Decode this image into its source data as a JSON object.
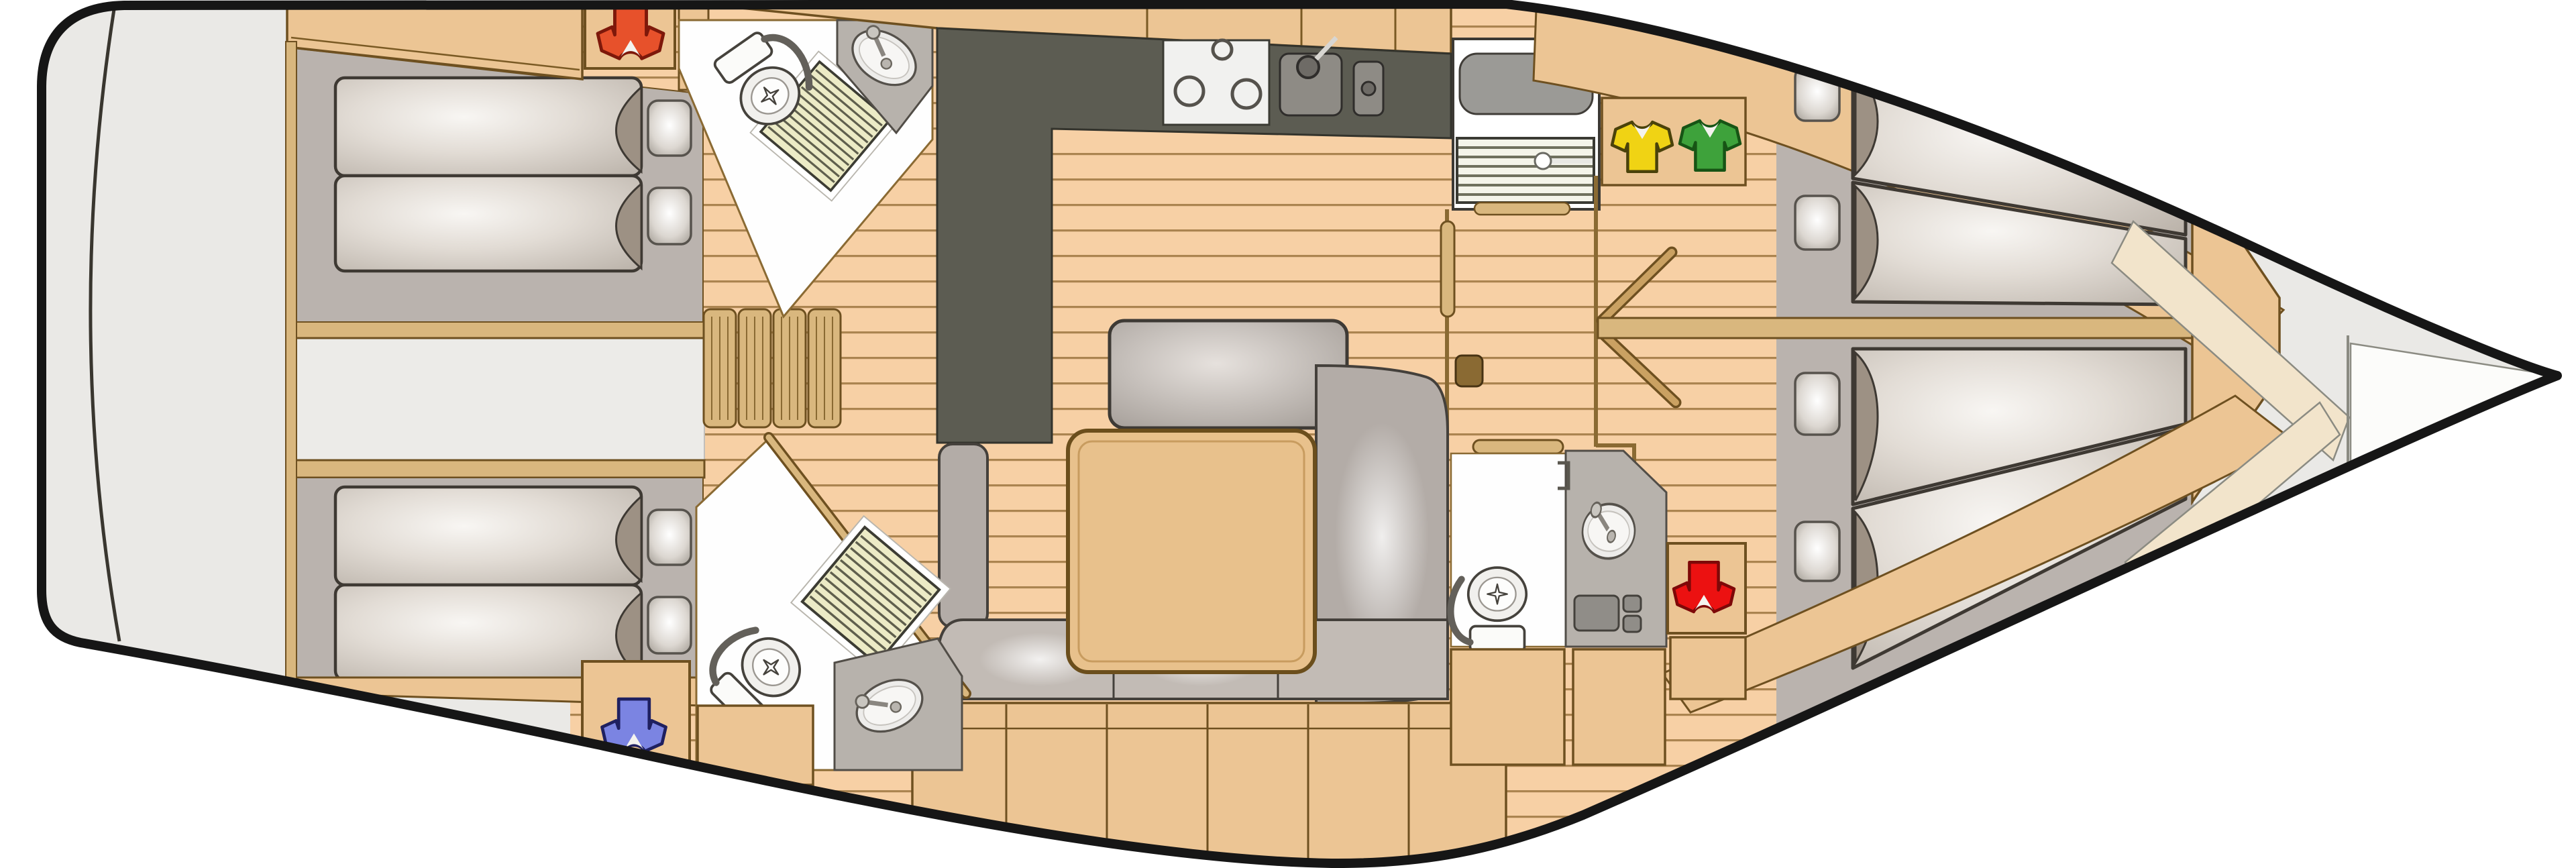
{
  "app": {
    "name": "yacht-floorplan",
    "description": "Top-view interior layout plan of a sailing yacht, bow pointing right"
  },
  "palette": {
    "hull_outline": "#161616",
    "deck": "#eae9e6",
    "floor": "#f7d0a5",
    "plank_line": "#ab8450",
    "wood": "#ecc594",
    "wood_light": "#d9b77e",
    "wood_dark": "#6e5020",
    "cabin_floor": "#bab3ae",
    "galley_counter": "#5c5c52",
    "counter_gray": "#b7b2ac",
    "white": "#fefefe",
    "shower_grate": "#ecebc6",
    "mattress_edge": "#3e3933",
    "sofa": "#b3aca7",
    "cushion": "#c2bbb5",
    "table": "#e8c18c",
    "bow_cream": "#f2e4cb"
  },
  "icons": {
    "orange_shirt": {
      "label": "crew berth marker - aft port cabin",
      "color": "#e7512b",
      "outline": "#7e180a"
    },
    "blue_shirt": {
      "label": "crew berth marker - aft starboard cabin",
      "color": "#7b84e2",
      "outline": "#1f2060"
    },
    "yellow_shirt": {
      "label": "crew berth marker - forward port cabin",
      "color": "#f0d314",
      "outline": "#4a420a"
    },
    "green_shirt": {
      "label": "crew berth marker - forward starboard cabin",
      "color": "#3ea23b",
      "outline": "#175415"
    },
    "red_shirt": {
      "label": "crew berth marker - forward cabin wardrobe",
      "color": "#ec1111",
      "outline": "#7e0808"
    }
  },
  "rooms": [
    {
      "id": "stern-deck",
      "name": "Stern deck"
    },
    {
      "id": "aft-cabin-port",
      "name": "Aft double cabin (top)"
    },
    {
      "id": "aft-cabin-starboard",
      "name": "Aft double cabin (bottom)"
    },
    {
      "id": "engine-compartment",
      "name": "Engine compartment"
    },
    {
      "id": "head-aft-port",
      "name": "Aft head with shower (top)"
    },
    {
      "id": "head-aft-starboard",
      "name": "Aft head with shower (bottom)"
    },
    {
      "id": "galley",
      "name": "L-shaped galley"
    },
    {
      "id": "saloon",
      "name": "Saloon with table, bench and sofa"
    },
    {
      "id": "companionway",
      "name": "Companionway with steps and hatch"
    },
    {
      "id": "forward-head",
      "name": "Forward head"
    },
    {
      "id": "forward-cabin-port",
      "name": "Forward double cabin (top)"
    },
    {
      "id": "forward-cabin-starboard",
      "name": "Forward double cabin (bottom)"
    },
    {
      "id": "bow-locker",
      "name": "Bow / anchor locker"
    }
  ],
  "fixtures": [
    "double berth with two mattresses and pillows (x4)",
    "toilet (x3)",
    "oval washbasin (x3)",
    "shower grate (x2)",
    "3-burner stove",
    "double galley sink",
    "fridge with sliding hatch",
    "companionway steps",
    "folding accordion door",
    "saloon table",
    "L-shaped sofa",
    "bench seat",
    "lockers and wardrobes",
    "cabin door swings"
  ]
}
